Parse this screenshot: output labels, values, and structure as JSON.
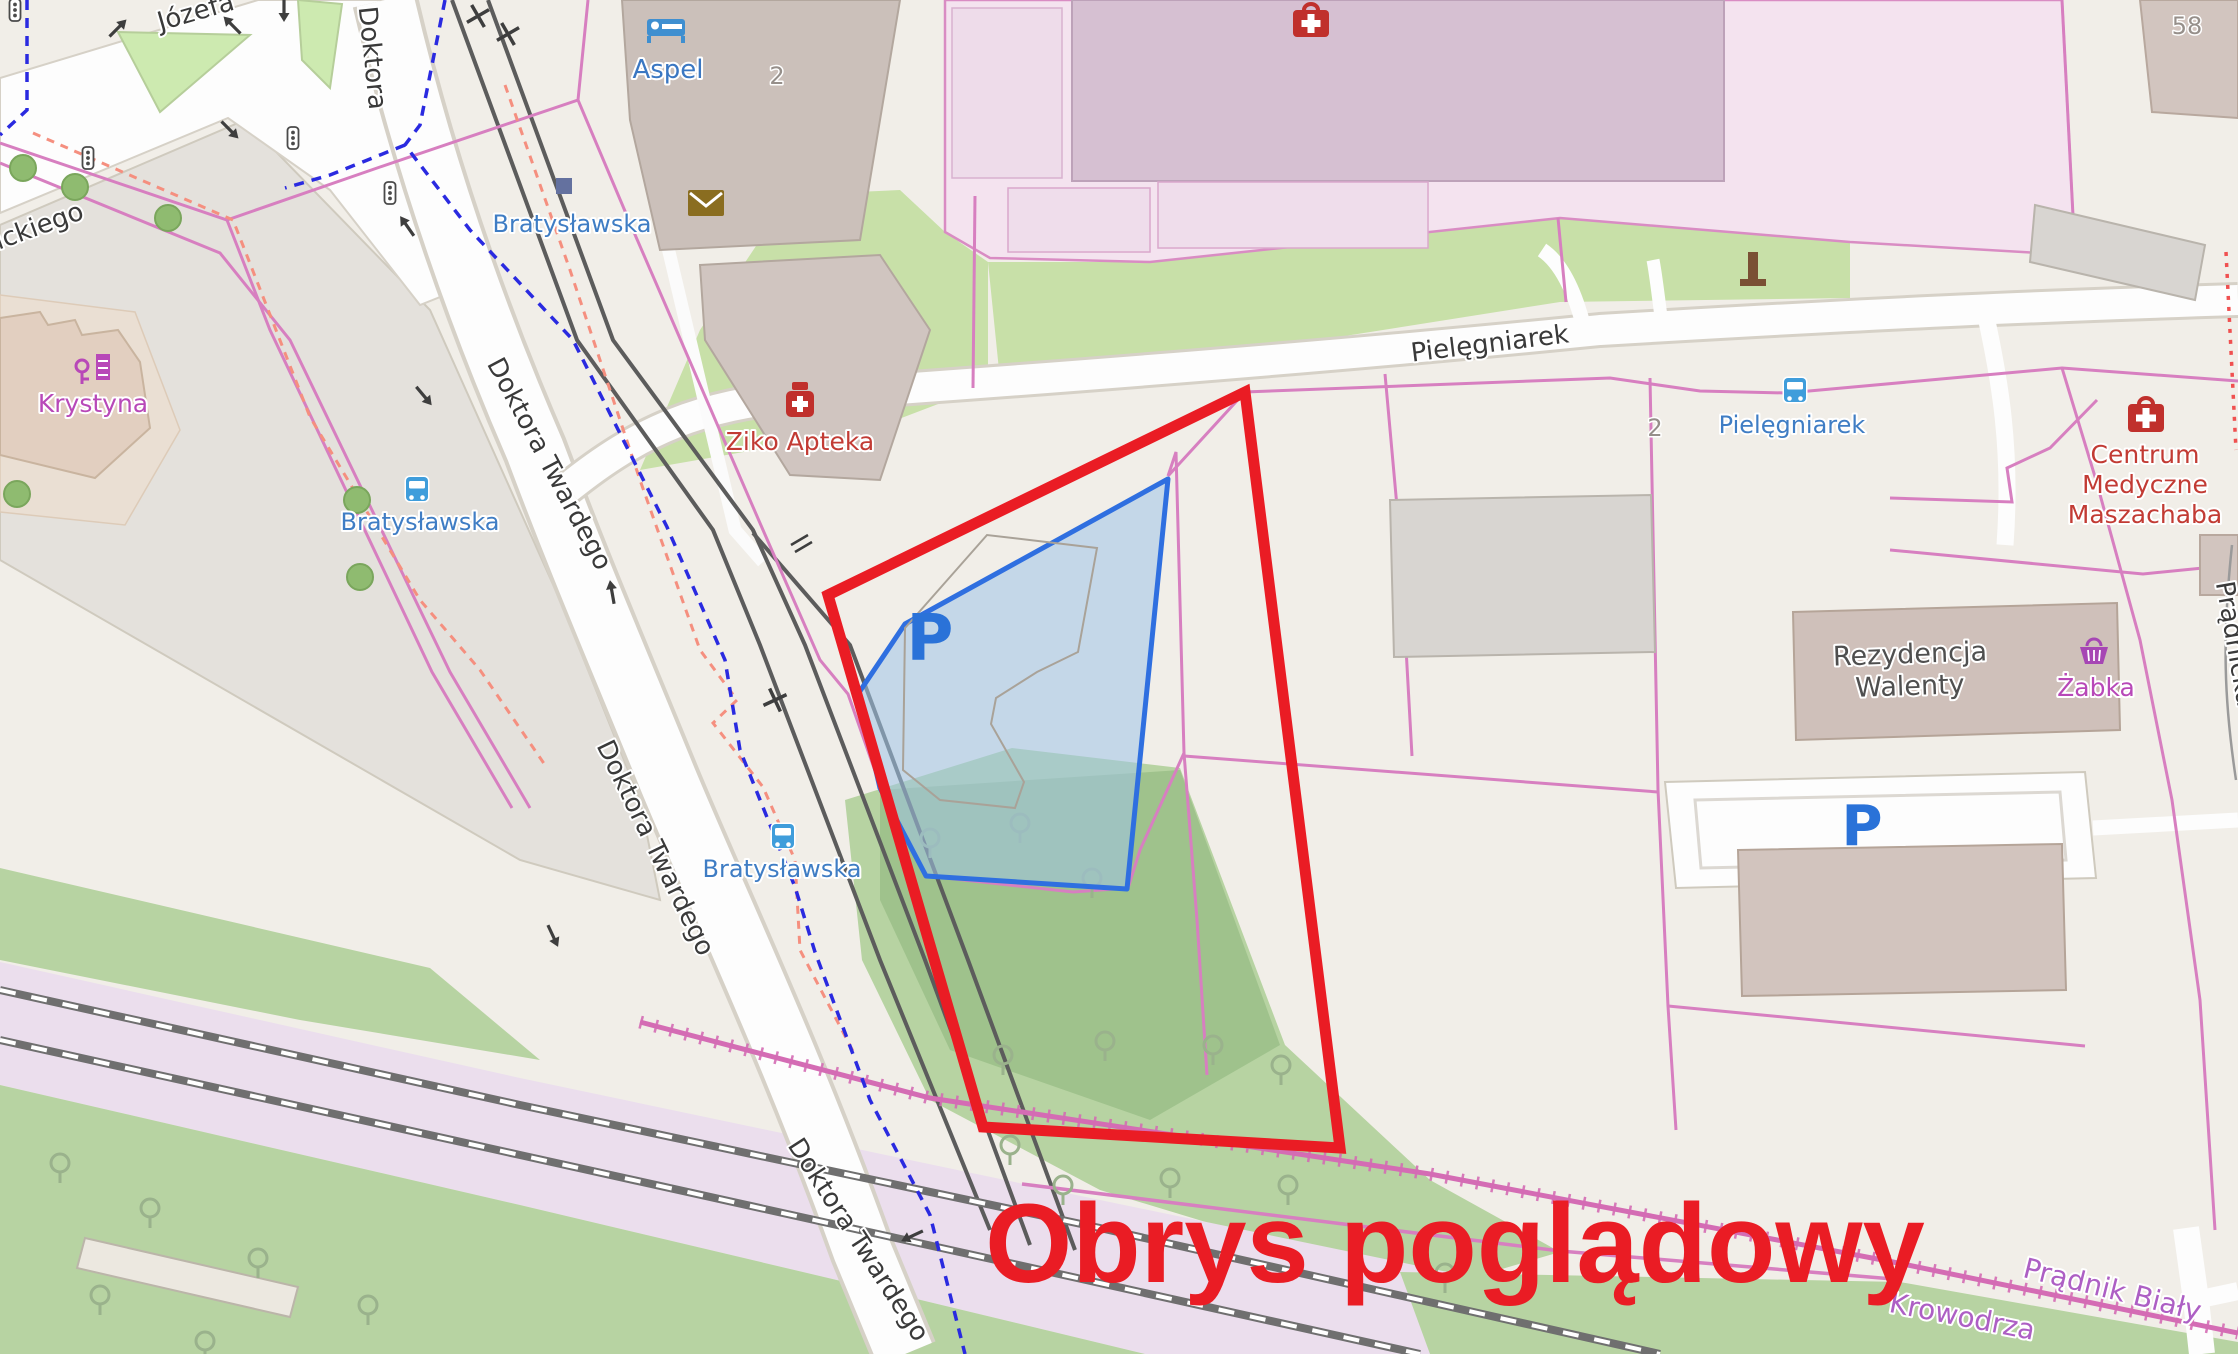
{
  "map": {
    "annotation": {
      "text": "Obrys poglądowy",
      "color": "#ea1c24"
    },
    "streets": {
      "jozefa": "Józefa",
      "ickiego": "ickiego",
      "doktora": "Doktora",
      "doktora_twardego": "Doktora Twardego",
      "pielegniarek": "Pielęgniarek",
      "pradnicka": "Prądnicka"
    },
    "transit_stops": {
      "bratyslawska": "Bratysławska",
      "pielegniarek": "Pielęgniarek"
    },
    "pois": {
      "aspel": "Aspel",
      "ziko_apteka": "Ziko Apteka",
      "krystyna": "Krystyna",
      "centrum_line1": "Centrum",
      "centrum_line2": "Medyczne",
      "centrum_line3": "Maszachaba",
      "rezydencja_line1": "Rezydencja",
      "rezydencja_line2": "Walenty",
      "zabka": "Żabka"
    },
    "districts": {
      "pradnik_bialy": "Prądnik Biały",
      "krowodrza": "Krowodrza"
    },
    "house_numbers": {
      "aspel": "2",
      "pielegniarek": "2",
      "topright": "58"
    },
    "parking_label": "P",
    "colors": {
      "red_outline": "#ea1c24",
      "parcel_blue": "#2f6fe0",
      "boundary_pink": "#d77fc0",
      "transit_blue": "#3f7dc4",
      "background": "#f1eee8"
    }
  }
}
